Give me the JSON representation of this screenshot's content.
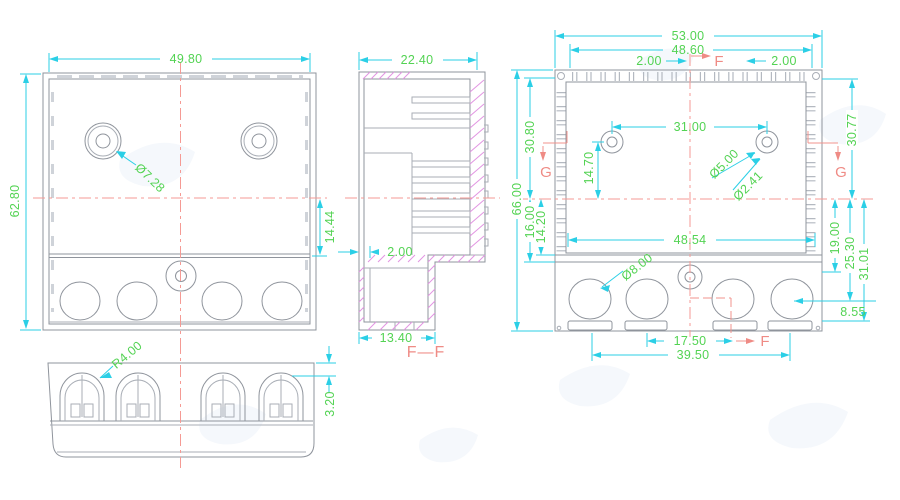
{
  "drawing": {
    "front_view": {
      "dims": {
        "width": "49.80",
        "height": "62.80",
        "hole_dia": "Ø7.28",
        "offset": "14.44"
      }
    },
    "bottom_view": {
      "dims": {
        "corner_radius": "R4.00",
        "lip_height": "3.20"
      }
    },
    "section_view": {
      "label": "F—F",
      "dims": {
        "depth": "22.40",
        "wall": "2.00",
        "base_width": "13.40"
      }
    },
    "rear_view": {
      "labels": {
        "section_f_top": "F",
        "section_f_bottom": "F",
        "section_g_left": "G",
        "section_g_right": "G"
      },
      "dims": {
        "overall_width": "53.00",
        "inner_width": "48.60",
        "tab_left": "2.00",
        "tab_right": "2.00",
        "hole_spacing": "31.00",
        "hole_drop": "14.70",
        "hole_dia": "Ø5.00",
        "hole_inner_dia": "Ø2.41",
        "height_left": "30.80",
        "height_right": "30.77",
        "overall_height": "66.00",
        "ledge_a": "16.00",
        "ledge_b": "14.20",
        "cavity_width": "48.54",
        "step_a": "19.00",
        "step_b": "25.30",
        "step_c": "31.01",
        "port_dia": "Ø8.00",
        "port_offset": "8.55",
        "slot_pitch": "17.50",
        "slot_span": "39.50"
      }
    }
  }
}
